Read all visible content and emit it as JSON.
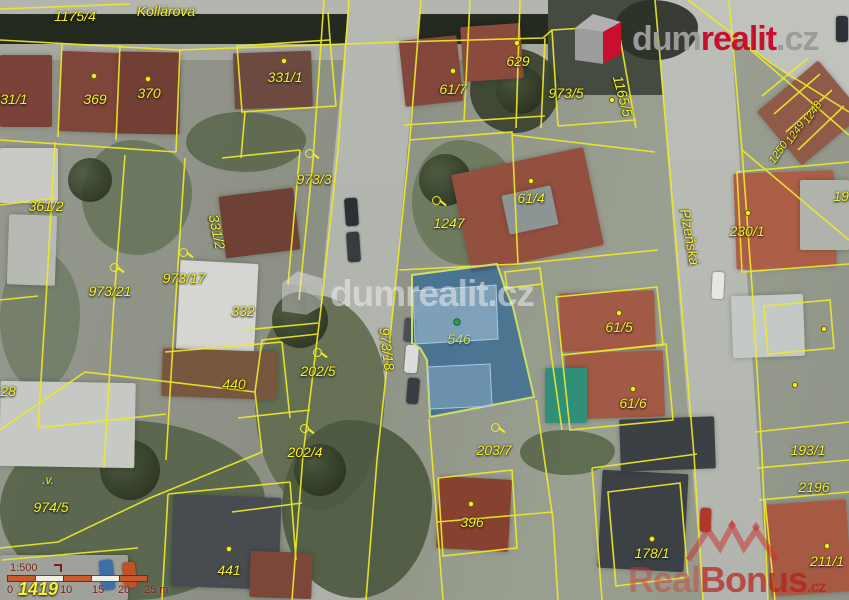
{
  "colors": {
    "parcel_line_yellow": "#efe92a",
    "highlight_fill_blue": "#1f6096",
    "highlight_border": "#cbe063",
    "brand_red": "#c8102e",
    "brand_grey": "#9b9b9b",
    "scale_maroon": "#7c2016",
    "scale_orange": "#c75b2d"
  },
  "brand_logo": {
    "part1": "dum",
    "part2": "realit",
    "tld": ".cz"
  },
  "watermarks": {
    "center": {
      "part1": "dum",
      "part2": "realit",
      "tld": ".cz"
    },
    "bottom_right": {
      "part1": "Real",
      "part2": "Bonus",
      "tld": ".cz"
    }
  },
  "icons": {
    "land_use_marsh": ".v."
  },
  "highlighted_parcel": {
    "number": "546"
  },
  "scale_bar": {
    "ratio": "1:500",
    "ticks": [
      "0",
      "10",
      "15",
      "20",
      "25 m"
    ],
    "overlapping_parcel_number": "1419"
  },
  "map": {
    "streets": {
      "top": "Kollárova",
      "right": "Plzeňská"
    },
    "labels": [
      {
        "text": "1175/4"
      },
      {
        "text": "Kollárova"
      },
      {
        "text": "369"
      },
      {
        "text": "370"
      },
      {
        "text": "331/1"
      },
      {
        "text": "331/1"
      },
      {
        "text": "61/7"
      },
      {
        "text": "629"
      },
      {
        "text": "973/5"
      },
      {
        "text": "1165/5"
      },
      {
        "text": "361/2"
      },
      {
        "text": "973/3"
      },
      {
        "text": "331/2"
      },
      {
        "text": "973/21"
      },
      {
        "text": "973/17"
      },
      {
        "text": "1247"
      },
      {
        "text": "61/4"
      },
      {
        "text": "Plzeňská"
      },
      {
        "text": "230/1"
      },
      {
        "text": "199"
      },
      {
        "text": "1248"
      },
      {
        "text": "1249"
      },
      {
        "text": "1250"
      },
      {
        "text": "973/18"
      },
      {
        "text": "546"
      },
      {
        "text": "202/5"
      },
      {
        "text": "61/5"
      },
      {
        "text": "61/6"
      },
      {
        "text": "332"
      },
      {
        "text": "440"
      },
      {
        "text": "28"
      },
      {
        "text": "202/4"
      },
      {
        "text": "203/7"
      },
      {
        "text": "974/5"
      },
      {
        "text": "441"
      },
      {
        "text": "396"
      },
      {
        "text": "178/1"
      },
      {
        "text": "2196"
      },
      {
        "text": "193/1"
      },
      {
        "text": "211/1"
      },
      {
        "text": "1419"
      }
    ]
  }
}
